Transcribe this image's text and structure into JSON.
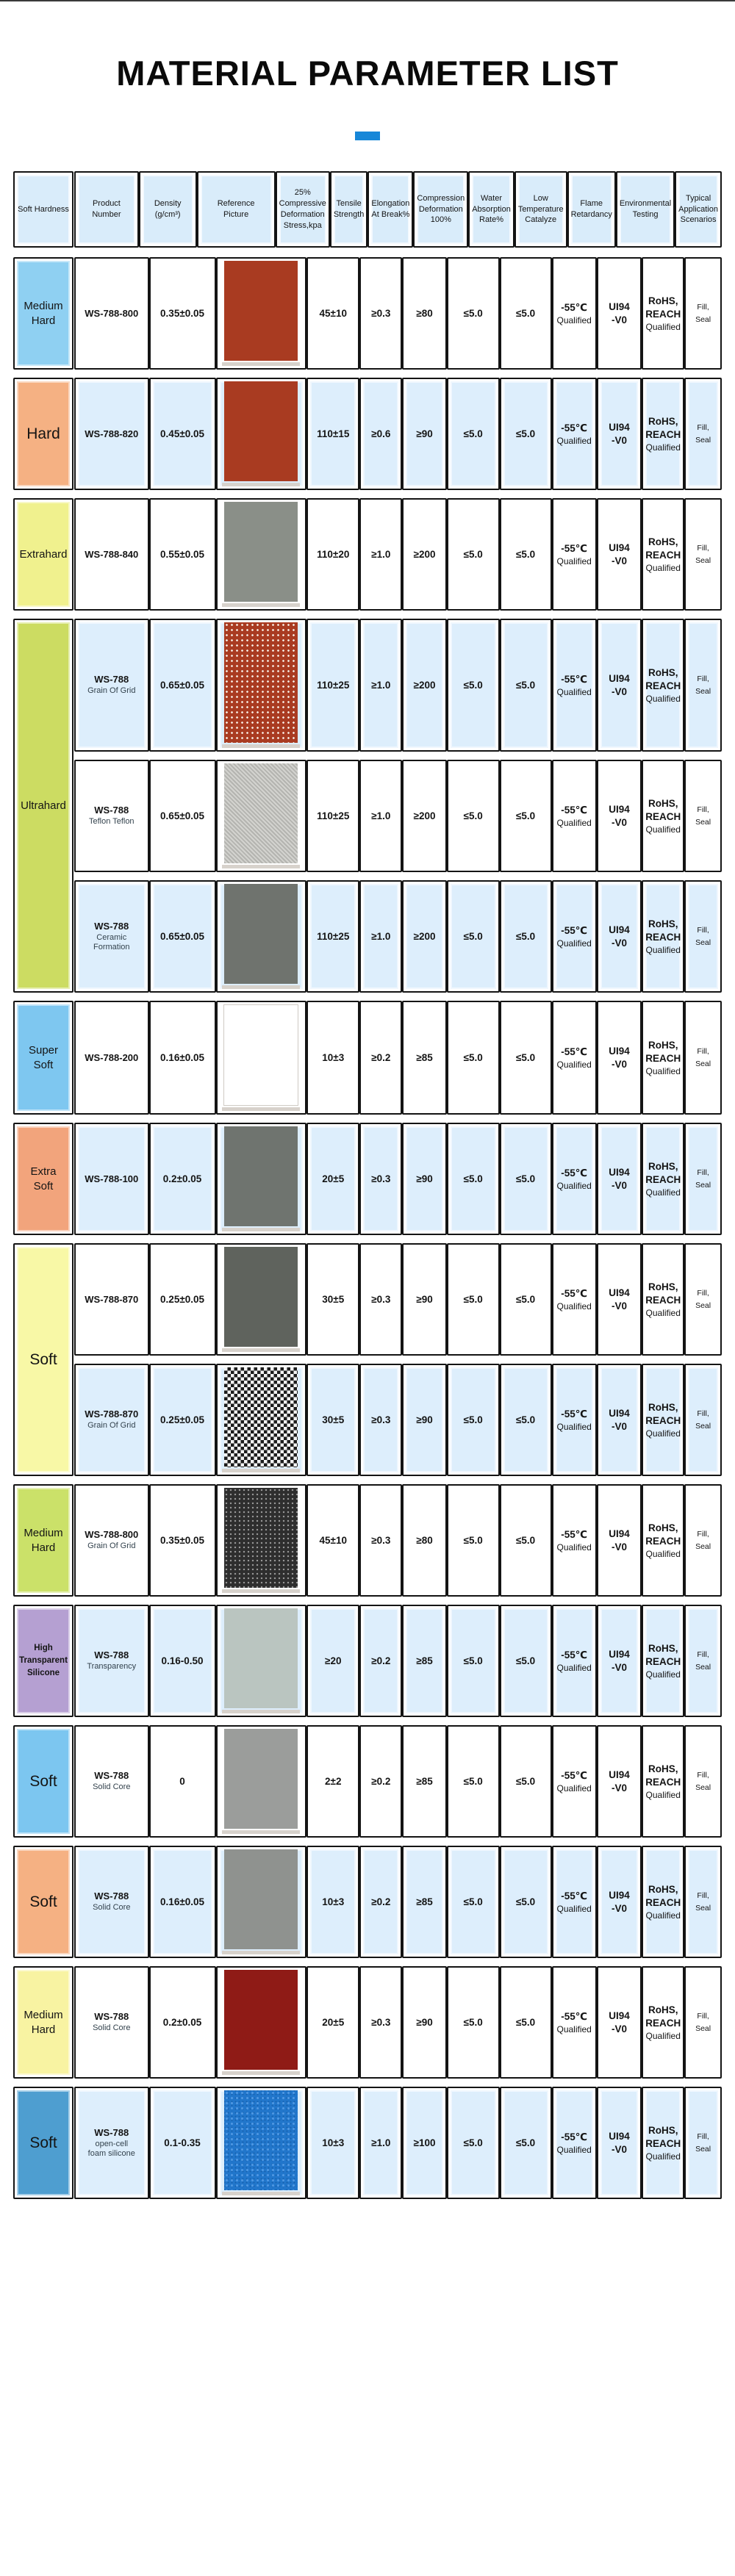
{
  "title": "MATERIAL PARAMETER LIST",
  "accent_color": "#1787d8",
  "header": {
    "columns": [
      {
        "key": "hardness",
        "label": "Soft Hardness"
      },
      {
        "key": "product",
        "label": "Product Number"
      },
      {
        "key": "density",
        "label": "Density\n(g/cm³)"
      },
      {
        "key": "picture",
        "label": "Reference\nPicture"
      },
      {
        "key": "stress",
        "label": "25% Compressive\nDeformation\nStress,kpa"
      },
      {
        "key": "tensile",
        "label": "Tensile\nStrength"
      },
      {
        "key": "elongation",
        "label": "Elongation\nAt Break%"
      },
      {
        "key": "compression",
        "label": "Compression\nDeformation\n100%"
      },
      {
        "key": "water",
        "label": "Water\nAbsorption\nRate%"
      },
      {
        "key": "low_temp",
        "label": "Low\nTemperature\nCatalyze"
      },
      {
        "key": "flame",
        "label": "Flame\nRetardancy"
      },
      {
        "key": "environmental",
        "label": "Environmental\nTesting"
      },
      {
        "key": "typical",
        "label": "Typical\nApplication\nScenarios"
      }
    ]
  },
  "table": {
    "row_bg_blue": "#ddeefc",
    "blocks": [
      {
        "hardness": "Medium\nHard",
        "color": "#8fd0f2",
        "label_size": "md",
        "rows": [
          {
            "bg": "white",
            "product": "WS-788-800",
            "product_sub": "",
            "density": "0.35±0.05",
            "picture": {
              "type": "solid",
              "color": "#a93b21"
            },
            "stress": "45±10",
            "tensile": "≥0.3",
            "elongation": "≥80",
            "compression": "≤5.0",
            "water": "≤5.0",
            "low_temp": {
              "value": "-55℃",
              "sub": "Qualified"
            },
            "flame": "UI94\n-V0",
            "environmental": {
              "value": "RoHS,\nREACH",
              "sub": "Qualified"
            },
            "typical": "Fill,\nSeal"
          }
        ]
      },
      {
        "hardness": "Hard",
        "color": "#f5b183",
        "label_size": "lg",
        "rows": [
          {
            "bg": "blue",
            "product": "WS-788-820",
            "product_sub": "",
            "density": "0.45±0.05",
            "picture": {
              "type": "solid",
              "color": "#a93b21"
            },
            "stress": "110±15",
            "tensile": "≥0.6",
            "elongation": "≥90",
            "compression": "≤5.0",
            "water": "≤5.0",
            "low_temp": {
              "value": "-55℃",
              "sub": "Qualified"
            },
            "flame": "UI94\n-V0",
            "environmental": {
              "value": "RoHS,\nREACH",
              "sub": "Qualified"
            },
            "typical": "Fill,\nSeal"
          }
        ]
      },
      {
        "hardness": "Extrahard",
        "color": "#f0f18e",
        "label_size": "md",
        "rows": [
          {
            "bg": "white",
            "product": "WS-788-840",
            "product_sub": "",
            "density": "0.55±0.05",
            "picture": {
              "type": "solid",
              "color": "#8a8f88"
            },
            "stress": "110±20",
            "tensile": "≥1.0",
            "elongation": "≥200",
            "compression": "≤5.0",
            "water": "≤5.0",
            "low_temp": {
              "value": "-55℃",
              "sub": "Qualified"
            },
            "flame": "UI94\n-V0",
            "environmental": {
              "value": "RoHS,\nREACH",
              "sub": "Qualified"
            },
            "typical": "Fill,\nSeal"
          }
        ]
      },
      {
        "hardness": "Ultrahard",
        "color": "#ccdc62",
        "label_size": "md",
        "rows": [
          {
            "bg": "blue",
            "product": "WS-788",
            "product_sub": "Grain Of Grid",
            "density": "0.65±0.05",
            "picture": {
              "type": "grid",
              "color": "#a93b21",
              "tall": true
            },
            "stress": "110±25",
            "tensile": "≥1.0",
            "elongation": "≥200",
            "compression": "≤5.0",
            "water": "≤5.0",
            "low_temp": {
              "value": "-55℃",
              "sub": "Qualified"
            },
            "flame": "UI94\n-V0",
            "environmental": {
              "value": "RoHS,\nREACH",
              "sub": "Qualified"
            },
            "typical": "Fill,\nSeal"
          },
          {
            "bg": "white",
            "product": "WS-788",
            "product_sub": "Teflon Teflon",
            "density": "0.65±0.05",
            "picture": {
              "type": "speckle",
              "color": "#c6c6c2"
            },
            "stress": "110±25",
            "tensile": "≥1.0",
            "elongation": "≥200",
            "compression": "≤5.0",
            "water": "≤5.0",
            "low_temp": {
              "value": "-55℃",
              "sub": "Qualified"
            },
            "flame": "UI94\n-V0",
            "environmental": {
              "value": "RoHS,\nREACH",
              "sub": "Qualified"
            },
            "typical": "Fill,\nSeal"
          },
          {
            "bg": "blue",
            "product": "WS-788",
            "product_sub": "Ceramic Formation",
            "density": "0.65±0.05",
            "picture": {
              "type": "solid",
              "color": "#6f736e"
            },
            "stress": "110±25",
            "tensile": "≥1.0",
            "elongation": "≥200",
            "compression": "≤5.0",
            "water": "≤5.0",
            "low_temp": {
              "value": "-55℃",
              "sub": "Qualified"
            },
            "flame": "UI94\n-V0",
            "environmental": {
              "value": "RoHS,\nREACH",
              "sub": "Qualified"
            },
            "typical": "Fill,\nSeal"
          }
        ]
      },
      {
        "hardness": "Super\nSoft",
        "color": "#7ec7f0",
        "label_size": "md",
        "rows": [
          {
            "bg": "white",
            "product": "WS-788-200",
            "product_sub": "",
            "density": "0.16±0.05",
            "picture": {
              "type": "white",
              "color": "#ffffff"
            },
            "stress": "10±3",
            "tensile": "≥0.2",
            "elongation": "≥85",
            "compression": "≤5.0",
            "water": "≤5.0",
            "low_temp": {
              "value": "-55℃",
              "sub": "Qualified"
            },
            "flame": "UI94\n-V0",
            "environmental": {
              "value": "RoHS,\nREACH",
              "sub": "Qualified"
            },
            "typical": "Fill,\nSeal"
          }
        ]
      },
      {
        "hardness": "Extra\nSoft",
        "color": "#f2a47c",
        "label_size": "md",
        "rows": [
          {
            "bg": "blue",
            "product": "WS-788-100",
            "product_sub": "",
            "density": "0.2±0.05",
            "picture": {
              "type": "solid",
              "color": "#6f746f"
            },
            "stress": "20±5",
            "tensile": "≥0.3",
            "elongation": "≥90",
            "compression": "≤5.0",
            "water": "≤5.0",
            "low_temp": {
              "value": "-55℃",
              "sub": "Qualified"
            },
            "flame": "UI94\n-V0",
            "environmental": {
              "value": "RoHS,\nREACH",
              "sub": "Qualified"
            },
            "typical": "Fill,\nSeal"
          }
        ]
      },
      {
        "hardness": "Soft",
        "color": "#f8f8a6",
        "label_size": "lg",
        "rows": [
          {
            "bg": "white",
            "product": "WS-788-870",
            "product_sub": "",
            "density": "0.25±0.05",
            "picture": {
              "type": "solid",
              "color": "#5f635d"
            },
            "stress": "30±5",
            "tensile": "≥0.3",
            "elongation": "≥90",
            "compression": "≤5.0",
            "water": "≤5.0",
            "low_temp": {
              "value": "-55℃",
              "sub": "Qualified"
            },
            "flame": "UI94\n-V0",
            "environmental": {
              "value": "RoHS,\nREACH",
              "sub": "Qualified"
            },
            "typical": "Fill,\nSeal"
          },
          {
            "bg": "blue",
            "product": "WS-788-870",
            "product_sub": "Grain Of Grid",
            "density": "0.25±0.05",
            "picture": {
              "type": "checker",
              "color": "#1c1c1c"
            },
            "stress": "30±5",
            "tensile": "≥0.3",
            "elongation": "≥90",
            "compression": "≤5.0",
            "water": "≤5.0",
            "low_temp": {
              "value": "-55℃",
              "sub": "Qualified"
            },
            "flame": "UI94\n-V0",
            "environmental": {
              "value": "RoHS,\nREACH",
              "sub": "Qualified"
            },
            "typical": "Fill,\nSeal"
          }
        ]
      },
      {
        "hardness": "Medium\nHard",
        "color": "#cbe169",
        "label_size": "md",
        "rows": [
          {
            "bg": "white",
            "product": "WS-788-800",
            "product_sub": "Grain Of Grid",
            "density": "0.35±0.05",
            "picture": {
              "type": "dots",
              "color": "#2e2e2e"
            },
            "stress": "45±10",
            "tensile": "≥0.3",
            "elongation": "≥80",
            "compression": "≤5.0",
            "water": "≤5.0",
            "low_temp": {
              "value": "-55℃",
              "sub": "Qualified"
            },
            "flame": "UI94\n-V0",
            "environmental": {
              "value": "RoHS,\nREACH",
              "sub": "Qualified"
            },
            "typical": "Fill,\nSeal"
          }
        ]
      },
      {
        "hardness": "High\nTransparent\nSilicone",
        "color": "#b5a0d2",
        "label_size": "sm",
        "rows": [
          {
            "bg": "blue",
            "product": "WS-788",
            "product_sub": "Transparency",
            "density": "0.16-0.50",
            "picture": {
              "type": "solid",
              "color": "#bac5c0"
            },
            "stress": "≥20",
            "tensile": "≥0.2",
            "elongation": "≥85",
            "compression": "≤5.0",
            "water": "≤5.0",
            "low_temp": {
              "value": "-55℃",
              "sub": "Qualified"
            },
            "flame": "UI94\n-V0",
            "environmental": {
              "value": "RoHS,\nREACH",
              "sub": "Qualified"
            },
            "typical": "Fill,\nSeal"
          }
        ]
      },
      {
        "hardness": "Soft",
        "color": "#7cc6f0",
        "label_size": "lg",
        "rows": [
          {
            "bg": "white",
            "product": "WS-788",
            "product_sub": "Solid Core",
            "density": "0",
            "picture": {
              "type": "solid",
              "color": "#9b9d9b"
            },
            "stress": "2±2",
            "tensile": "≥0.2",
            "elongation": "≥85",
            "compression": "≤5.0",
            "water": "≤5.0",
            "low_temp": {
              "value": "-55℃",
              "sub": "Qualified"
            },
            "flame": "UI94\n-V0",
            "environmental": {
              "value": "RoHS,\nREACH",
              "sub": "Qualified"
            },
            "typical": "Fill,\nSeal"
          }
        ]
      },
      {
        "hardness": "Soft",
        "color": "#f5b183",
        "label_size": "lg",
        "rows": [
          {
            "bg": "blue",
            "product": "WS-788",
            "product_sub": "Solid Core",
            "density": "0.16±0.05",
            "picture": {
              "type": "solid",
              "color": "#8f928f"
            },
            "stress": "10±3",
            "tensile": "≥0.2",
            "elongation": "≥85",
            "compression": "≤5.0",
            "water": "≤5.0",
            "low_temp": {
              "value": "-55℃",
              "sub": "Qualified"
            },
            "flame": "UI94\n-V0",
            "environmental": {
              "value": "RoHS,\nREACH",
              "sub": "Qualified"
            },
            "typical": "Fill,\nSeal"
          }
        ]
      },
      {
        "hardness": "Medium\nHard",
        "color": "#f8f3a2",
        "label_size": "md",
        "rows": [
          {
            "bg": "white",
            "product": "WS-788",
            "product_sub": "Solid Core",
            "density": "0.2±0.05",
            "picture": {
              "type": "solid",
              "color": "#8f1b16"
            },
            "stress": "20±5",
            "tensile": "≥0.3",
            "elongation": "≥90",
            "compression": "≤5.0",
            "water": "≤5.0",
            "low_temp": {
              "value": "-55℃",
              "sub": "Qualified"
            },
            "flame": "UI94\n-V0",
            "environmental": {
              "value": "RoHS,\nREACH",
              "sub": "Qualified"
            },
            "typical": "Fill,\nSeal"
          }
        ]
      },
      {
        "hardness": "Soft",
        "color": "#4e9ed0",
        "label_size": "lg",
        "rows": [
          {
            "bg": "blue",
            "product": "WS-788",
            "product_sub": "open-cell\nfoam silicone",
            "density": "0.1-0.35",
            "picture": {
              "type": "foam",
              "color": "#2176cb"
            },
            "stress": "10±3",
            "tensile": "≥1.0",
            "elongation": "≥100",
            "compression": "≤5.0",
            "water": "≤5.0",
            "low_temp": {
              "value": "-55℃",
              "sub": "Qualified"
            },
            "flame": "UI94\n-V0",
            "environmental": {
              "value": "RoHS,\nREACH",
              "sub": "Qualified"
            },
            "typical": "Fill,\nSeal"
          }
        ]
      }
    ]
  }
}
